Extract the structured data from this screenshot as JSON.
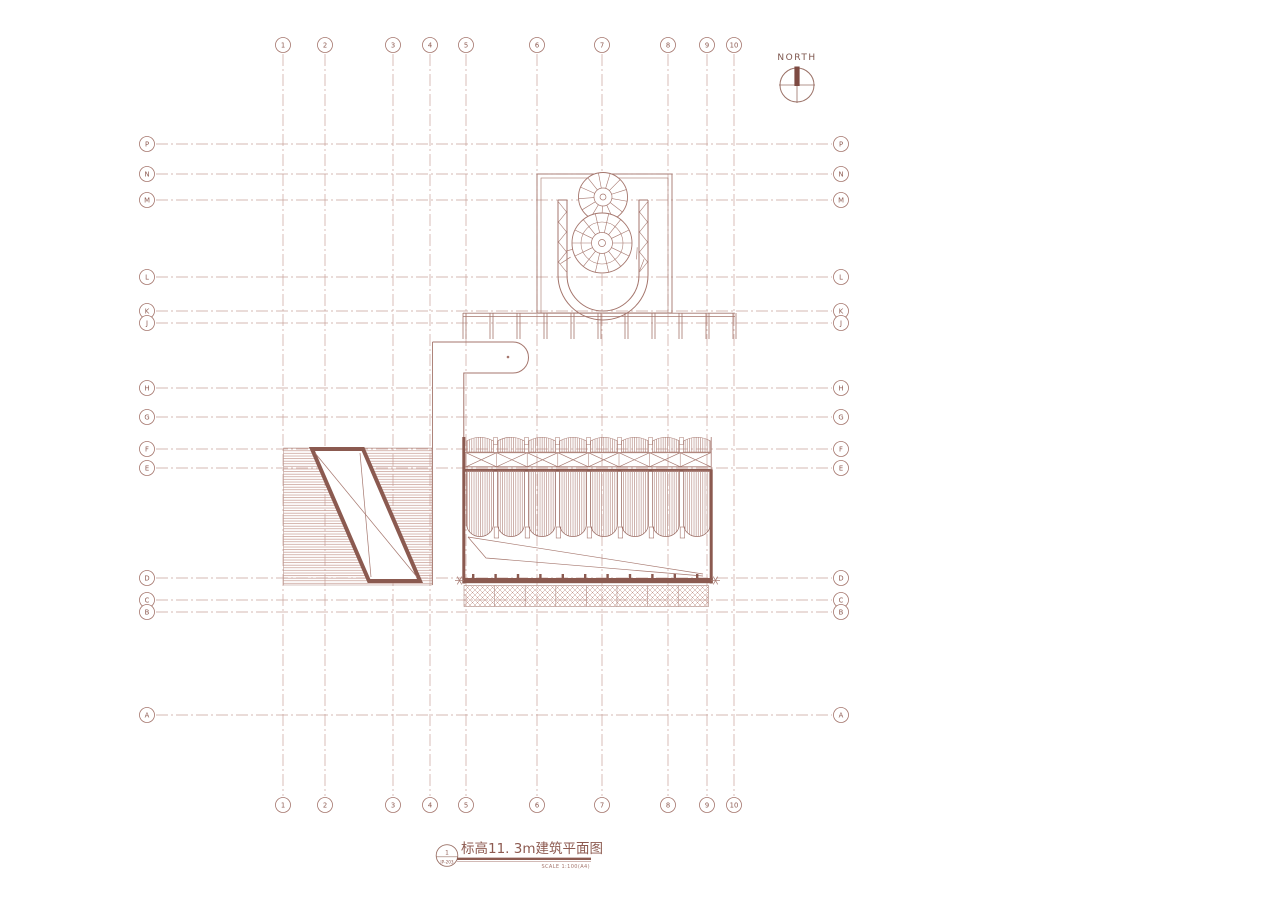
{
  "sheet": {
    "north": {
      "label": "NORTH"
    },
    "titleblock": {
      "ref_number": "1",
      "ref_sheet": "JP-203",
      "title": "标高11. 3m建筑平面图",
      "scale": "SCALE 1:100(A4)"
    },
    "colors": {
      "line": "#a5766d",
      "light": "#c9a59e",
      "dark": "#8b5a50",
      "hatch": "#c4988f",
      "grid": "#c8a19a",
      "text": "#8d5a50"
    },
    "grid": {
      "columns": [
        {
          "label": "1",
          "x": 283
        },
        {
          "label": "2",
          "x": 325
        },
        {
          "label": "3",
          "x": 393
        },
        {
          "label": "4",
          "x": 430
        },
        {
          "label": "5",
          "x": 466
        },
        {
          "label": "6",
          "x": 537
        },
        {
          "label": "7",
          "x": 602
        },
        {
          "label": "8",
          "x": 668
        },
        {
          "label": "9",
          "x": 707
        },
        {
          "label": "10",
          "x": 734
        }
      ],
      "rows": [
        {
          "label": "P",
          "y": 144
        },
        {
          "label": "N",
          "y": 174
        },
        {
          "label": "M",
          "y": 200
        },
        {
          "label": "L",
          "y": 277
        },
        {
          "label": "K",
          "y": 311
        },
        {
          "label": "J",
          "y": 323
        },
        {
          "label": "H",
          "y": 388
        },
        {
          "label": "G",
          "y": 417
        },
        {
          "label": "F",
          "y": 449
        },
        {
          "label": "E",
          "y": 468
        },
        {
          "label": "D",
          "y": 578
        },
        {
          "label": "C",
          "y": 600
        },
        {
          "label": "B",
          "y": 612
        },
        {
          "label": "A",
          "y": 715
        }
      ]
    }
  }
}
